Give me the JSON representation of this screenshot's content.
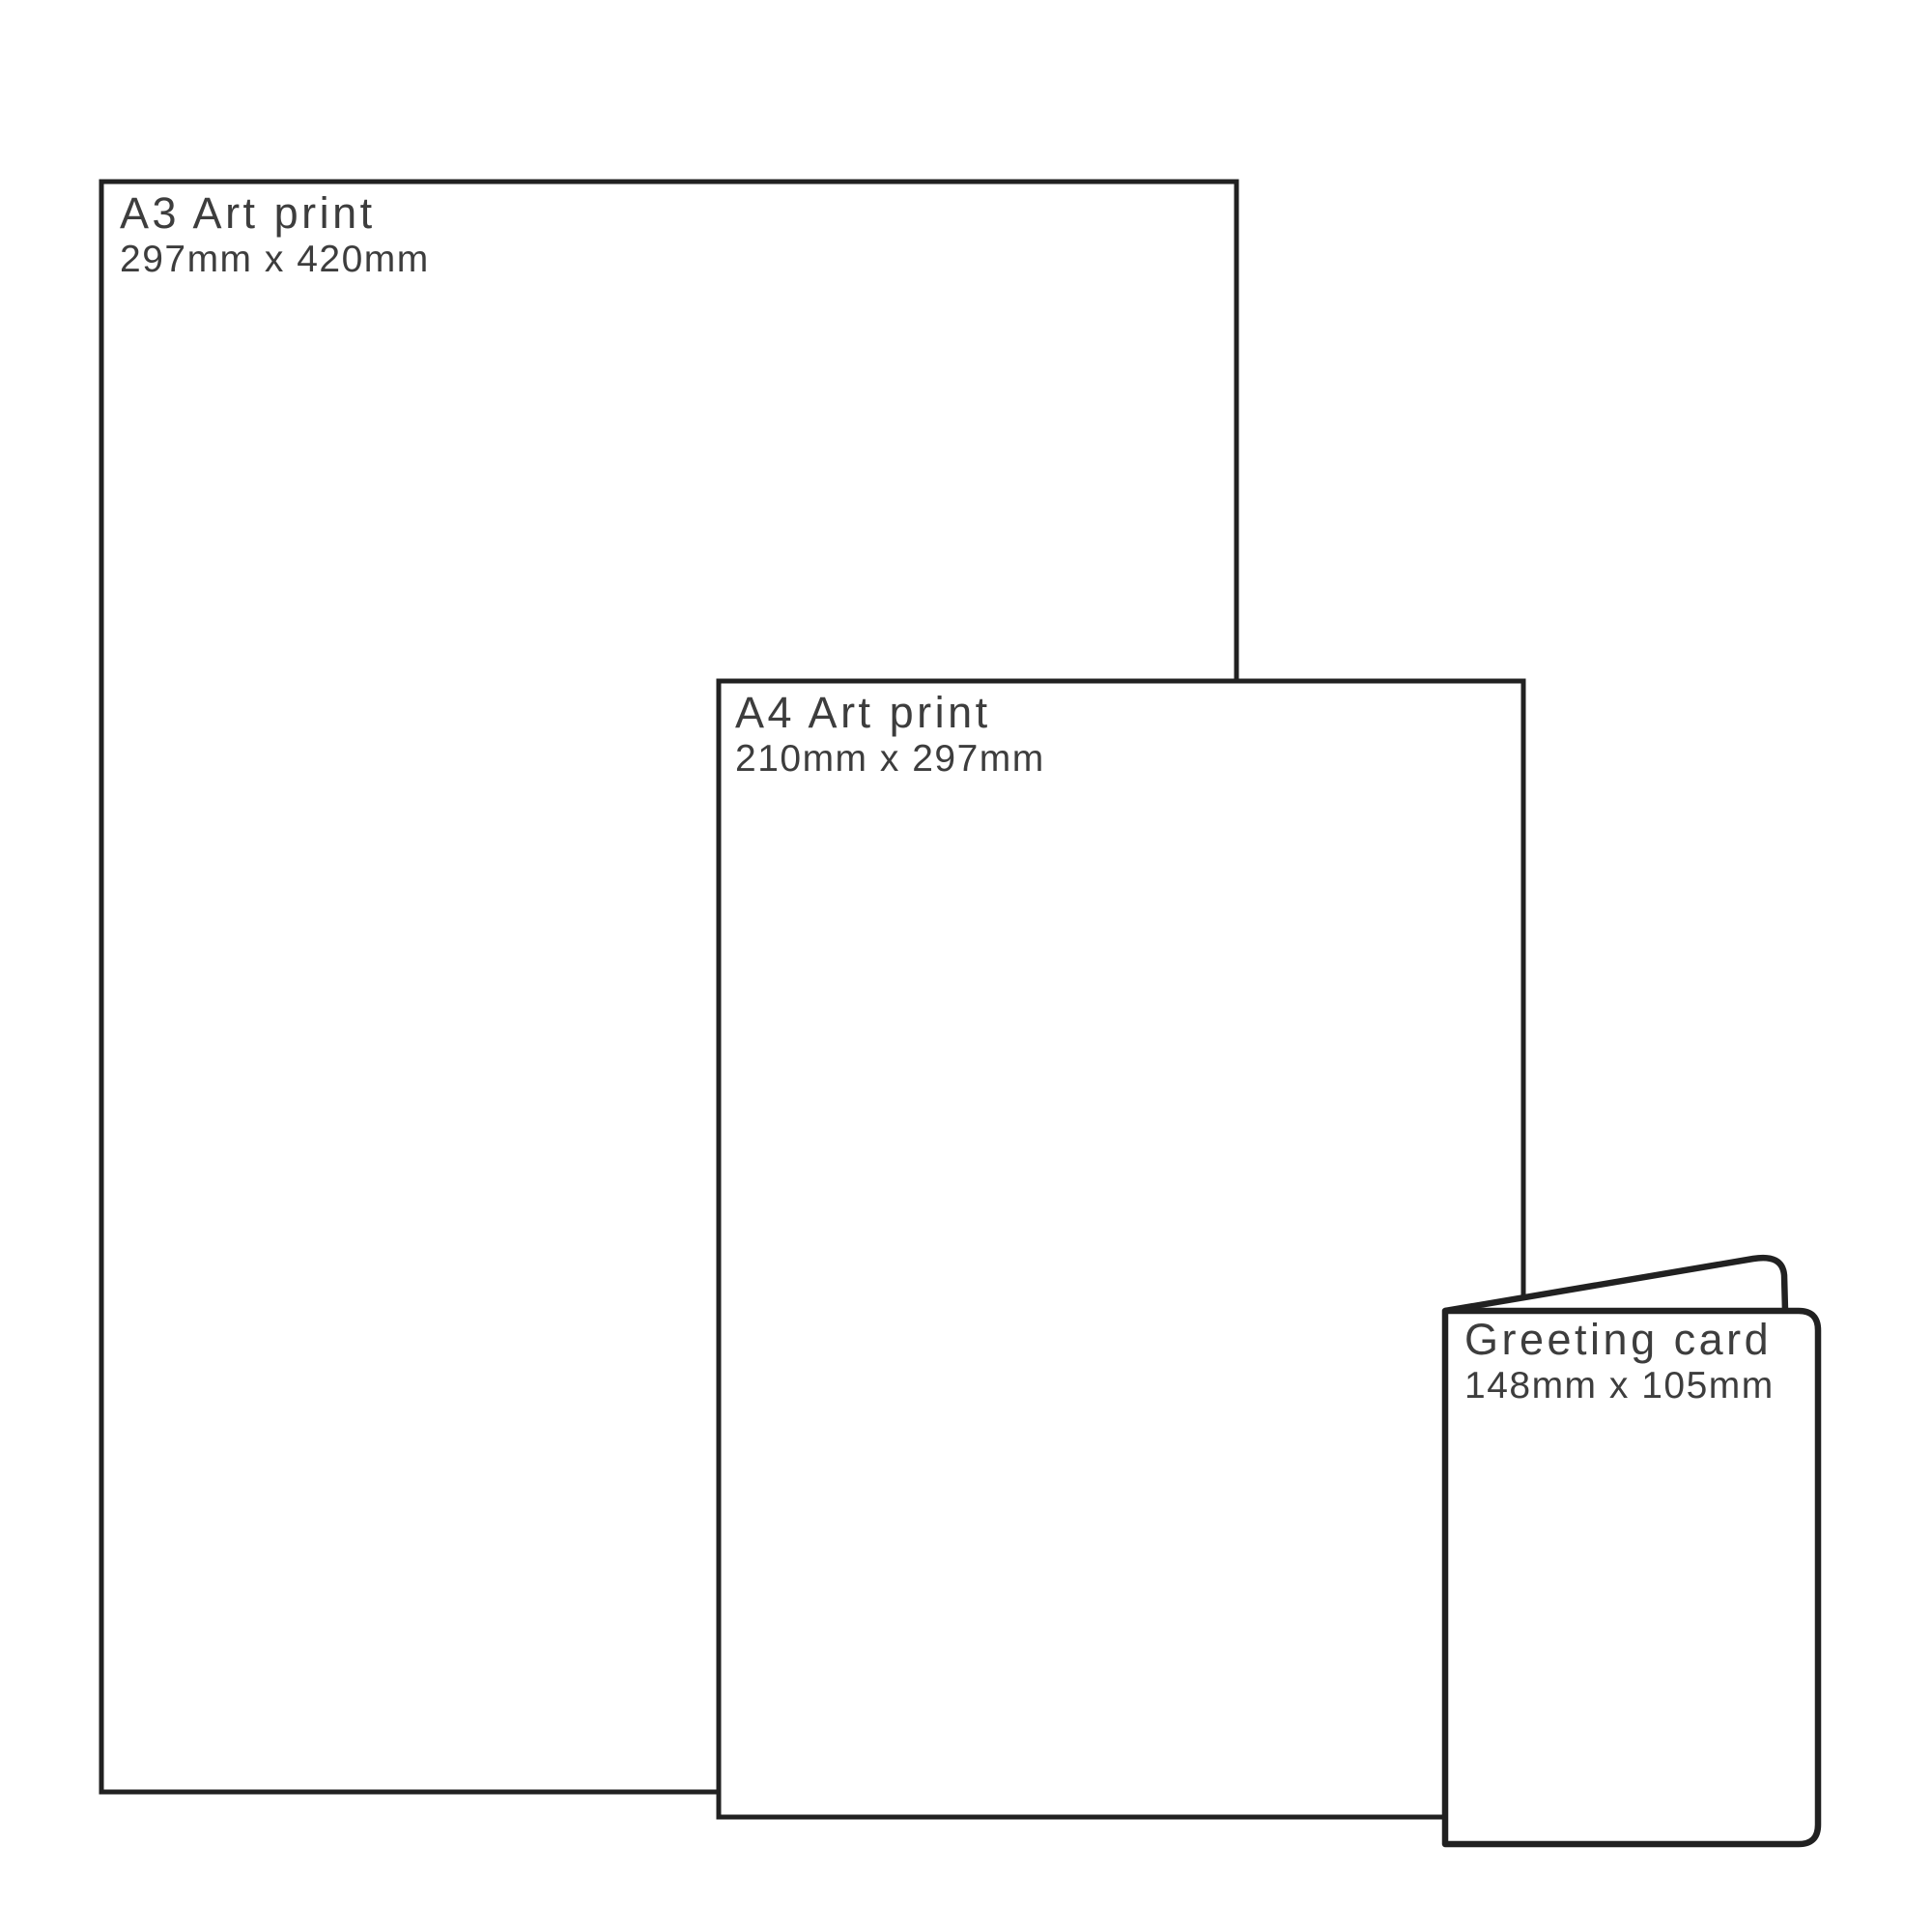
{
  "colors": {
    "background": "#ffffff",
    "stroke": "#212121",
    "text": "#3d3d3d",
    "fill": "#ffffff"
  },
  "items": [
    {
      "id": "a3-print",
      "title": "A3 Art print",
      "dimensions": "297mm x 420mm"
    },
    {
      "id": "a4-print",
      "title": "A4 Art print",
      "dimensions": "210mm x 297mm"
    },
    {
      "id": "greeting-card",
      "title": "Greeting card",
      "dimensions": "148mm x 105mm"
    }
  ]
}
